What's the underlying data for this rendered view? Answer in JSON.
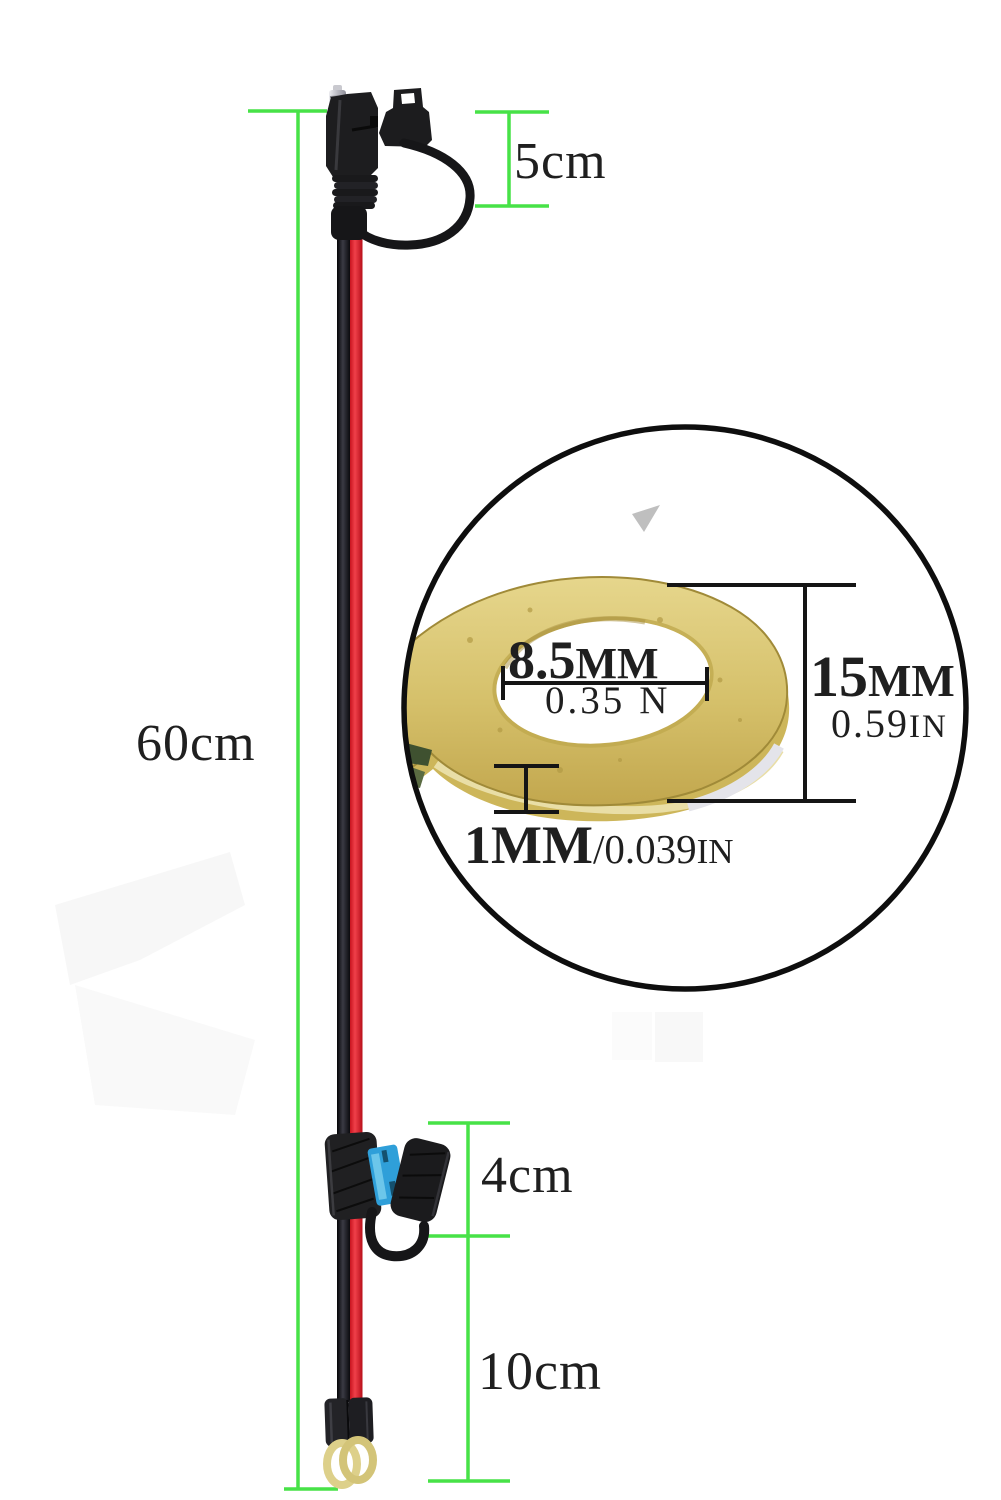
{
  "figure": {
    "type": "product-dimension-photo",
    "dimensions": {
      "connector_length": "5cm",
      "cable_length": "60cm",
      "fuse_holder_length": "4cm",
      "lead_length": "10cm"
    },
    "magnifier": {
      "hole_diameter": {
        "value": "8.5",
        "unit": "MM"
      },
      "hole_diameter_inches": {
        "value": "0.35",
        "unit": "N"
      },
      "outer_diameter": {
        "value": "15",
        "unit": "MM"
      },
      "outer_diameter_inches": {
        "value": "0.59",
        "unit": "IN"
      },
      "thickness": {
        "value": "1",
        "unit": "MM"
      },
      "thickness_inches": {
        "value": "/0.039",
        "unit": "IN"
      }
    },
    "colors": {
      "measure_line_green": "#47e247",
      "text": "#1d1d1d",
      "wire_red": "#e41e28",
      "wire_black": "#17171c",
      "fuse_blue": "#2f9fd9",
      "brass": "#d5c06a",
      "magnifier_ring": "#0e0e0e"
    }
  }
}
